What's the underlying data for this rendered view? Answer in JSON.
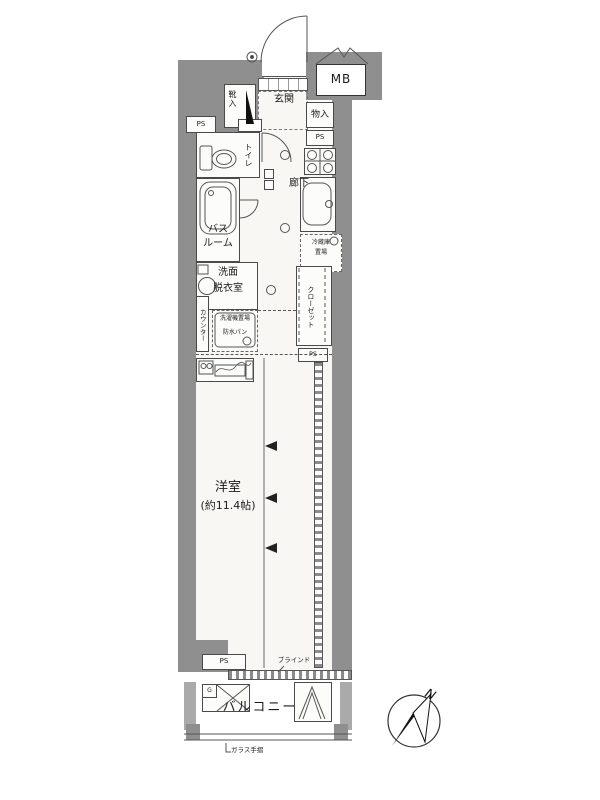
{
  "labels": {
    "mb": "MB",
    "entrance": "玄関",
    "shoe_cabinet": "靴入",
    "storage": "物入",
    "ps": "PS",
    "toilet": "トイレ",
    "hallway": "廊下",
    "bathroom_line1": "バス",
    "bathroom_line2": "ルーム",
    "washroom_line1": "洗面",
    "washroom_line2": "脱衣室",
    "counter": "カウンター",
    "laundry_space": "洗濯機置場",
    "waterproof_pan": "防水パン",
    "fridge_line1": "冷蔵庫",
    "fridge_line2": "置場",
    "closet": "クローゼット",
    "room_name": "洋室",
    "room_size": "(約11.4帖)",
    "blind": "ブラインド",
    "balcony": "バルコニー",
    "glass_railing": "ガラス手摺",
    "water_heater_mark": "G",
    "compass_north": "N"
  },
  "colors": {
    "wall": "#8f8f8f",
    "balcony_wall": "#aaaaaa",
    "line": "#4a4a4a",
    "floor": "#f8f7f4"
  }
}
